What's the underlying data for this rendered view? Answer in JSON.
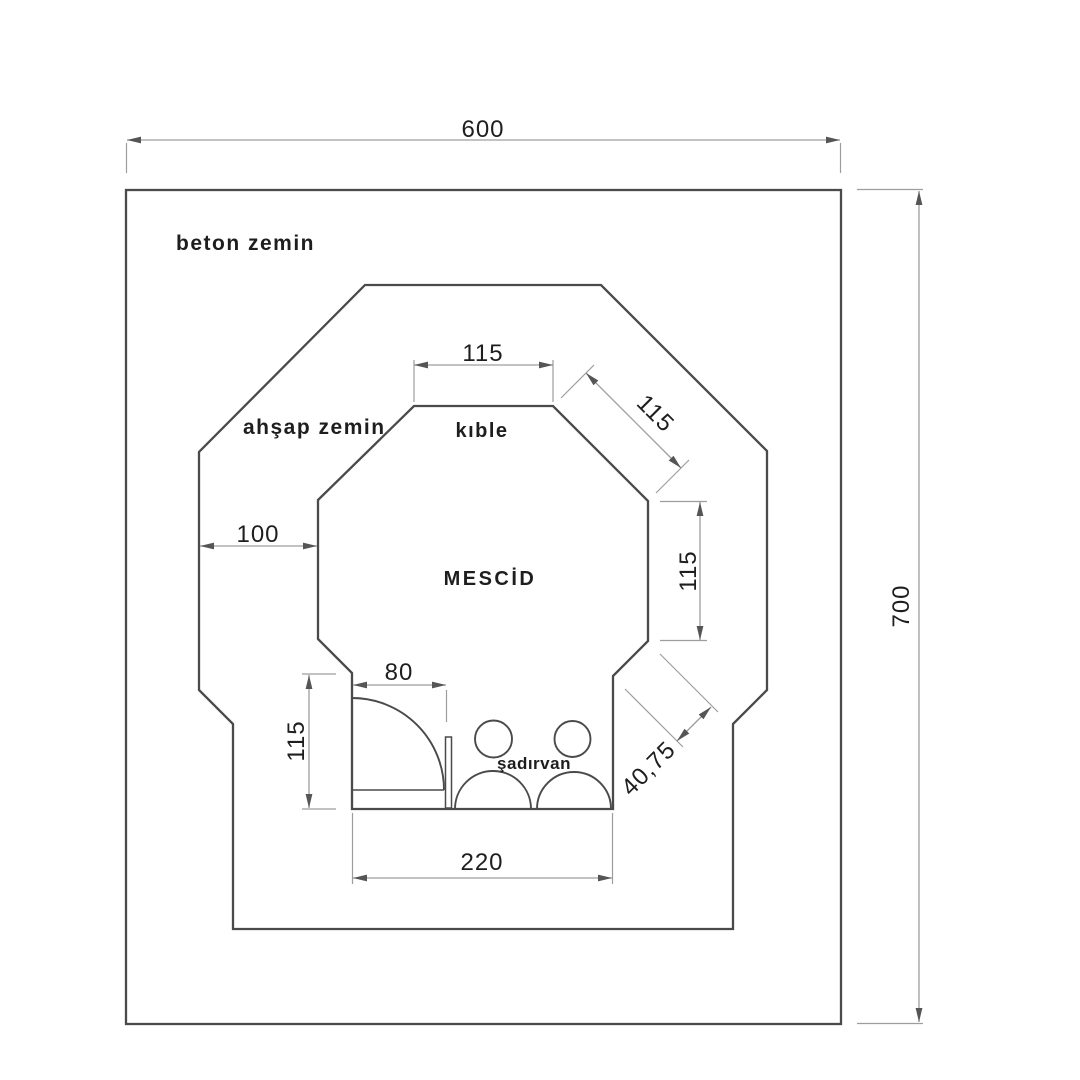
{
  "drawing": {
    "type": "architectural-floor-plan",
    "labels": {
      "outer_floor": "beton zemin",
      "middle_floor": "ahşap zemin",
      "qibla": "kıble",
      "room": "MESCİD",
      "fountain": "şadırvan"
    },
    "dimensions": {
      "outer_width": "600",
      "outer_height": "700",
      "room_top_edge": "115",
      "room_upper_right_diagonal": "115",
      "room_right_edge": "115",
      "walkway_left_gap": "100",
      "door_opening": "80",
      "entry_left_wall": "115",
      "entry_opening_width": "220",
      "lower_right_diagonal": "40,75"
    },
    "colors": {
      "background": "#ffffff",
      "wall_line": "#4a4a4a",
      "dimension_line": "#9d9d9d",
      "text": "#1e1e1e"
    }
  }
}
